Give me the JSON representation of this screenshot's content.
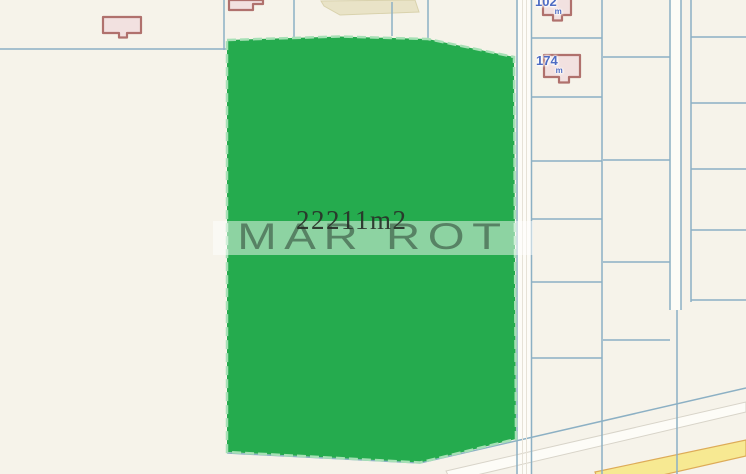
{
  "map": {
    "watermark": "MAR ROT",
    "parcel": {
      "area_label": "22211m2"
    },
    "buildings": [
      {
        "label": "102",
        "unit": "m"
      },
      {
        "label": "174",
        "unit": "m"
      }
    ],
    "colors": {
      "background": "#f6f3ea",
      "parcel-line": "#8cb0c4",
      "parcel-green": "#25ab4e",
      "parcel-green-edge": "#a6e0b5",
      "road-fill": "#fdfcf7",
      "road-inner-line": "#e6e2d7",
      "road-yellow": "#f7e992",
      "road-yellow-edge": "#ddab58",
      "field-tan": "#e9e3c7",
      "field-tan-edge": "#d9d2ad",
      "building-fill": "#f2e1e0",
      "building-stroke": "#b0716d",
      "house-label-blue": "#4e6cc3",
      "watermark-band": "rgba(255,255,255,0.48)",
      "watermark-text": "rgba(55,80,62,0.62)",
      "area-label-text": "rgba(40,48,40,0.92)"
    }
  }
}
